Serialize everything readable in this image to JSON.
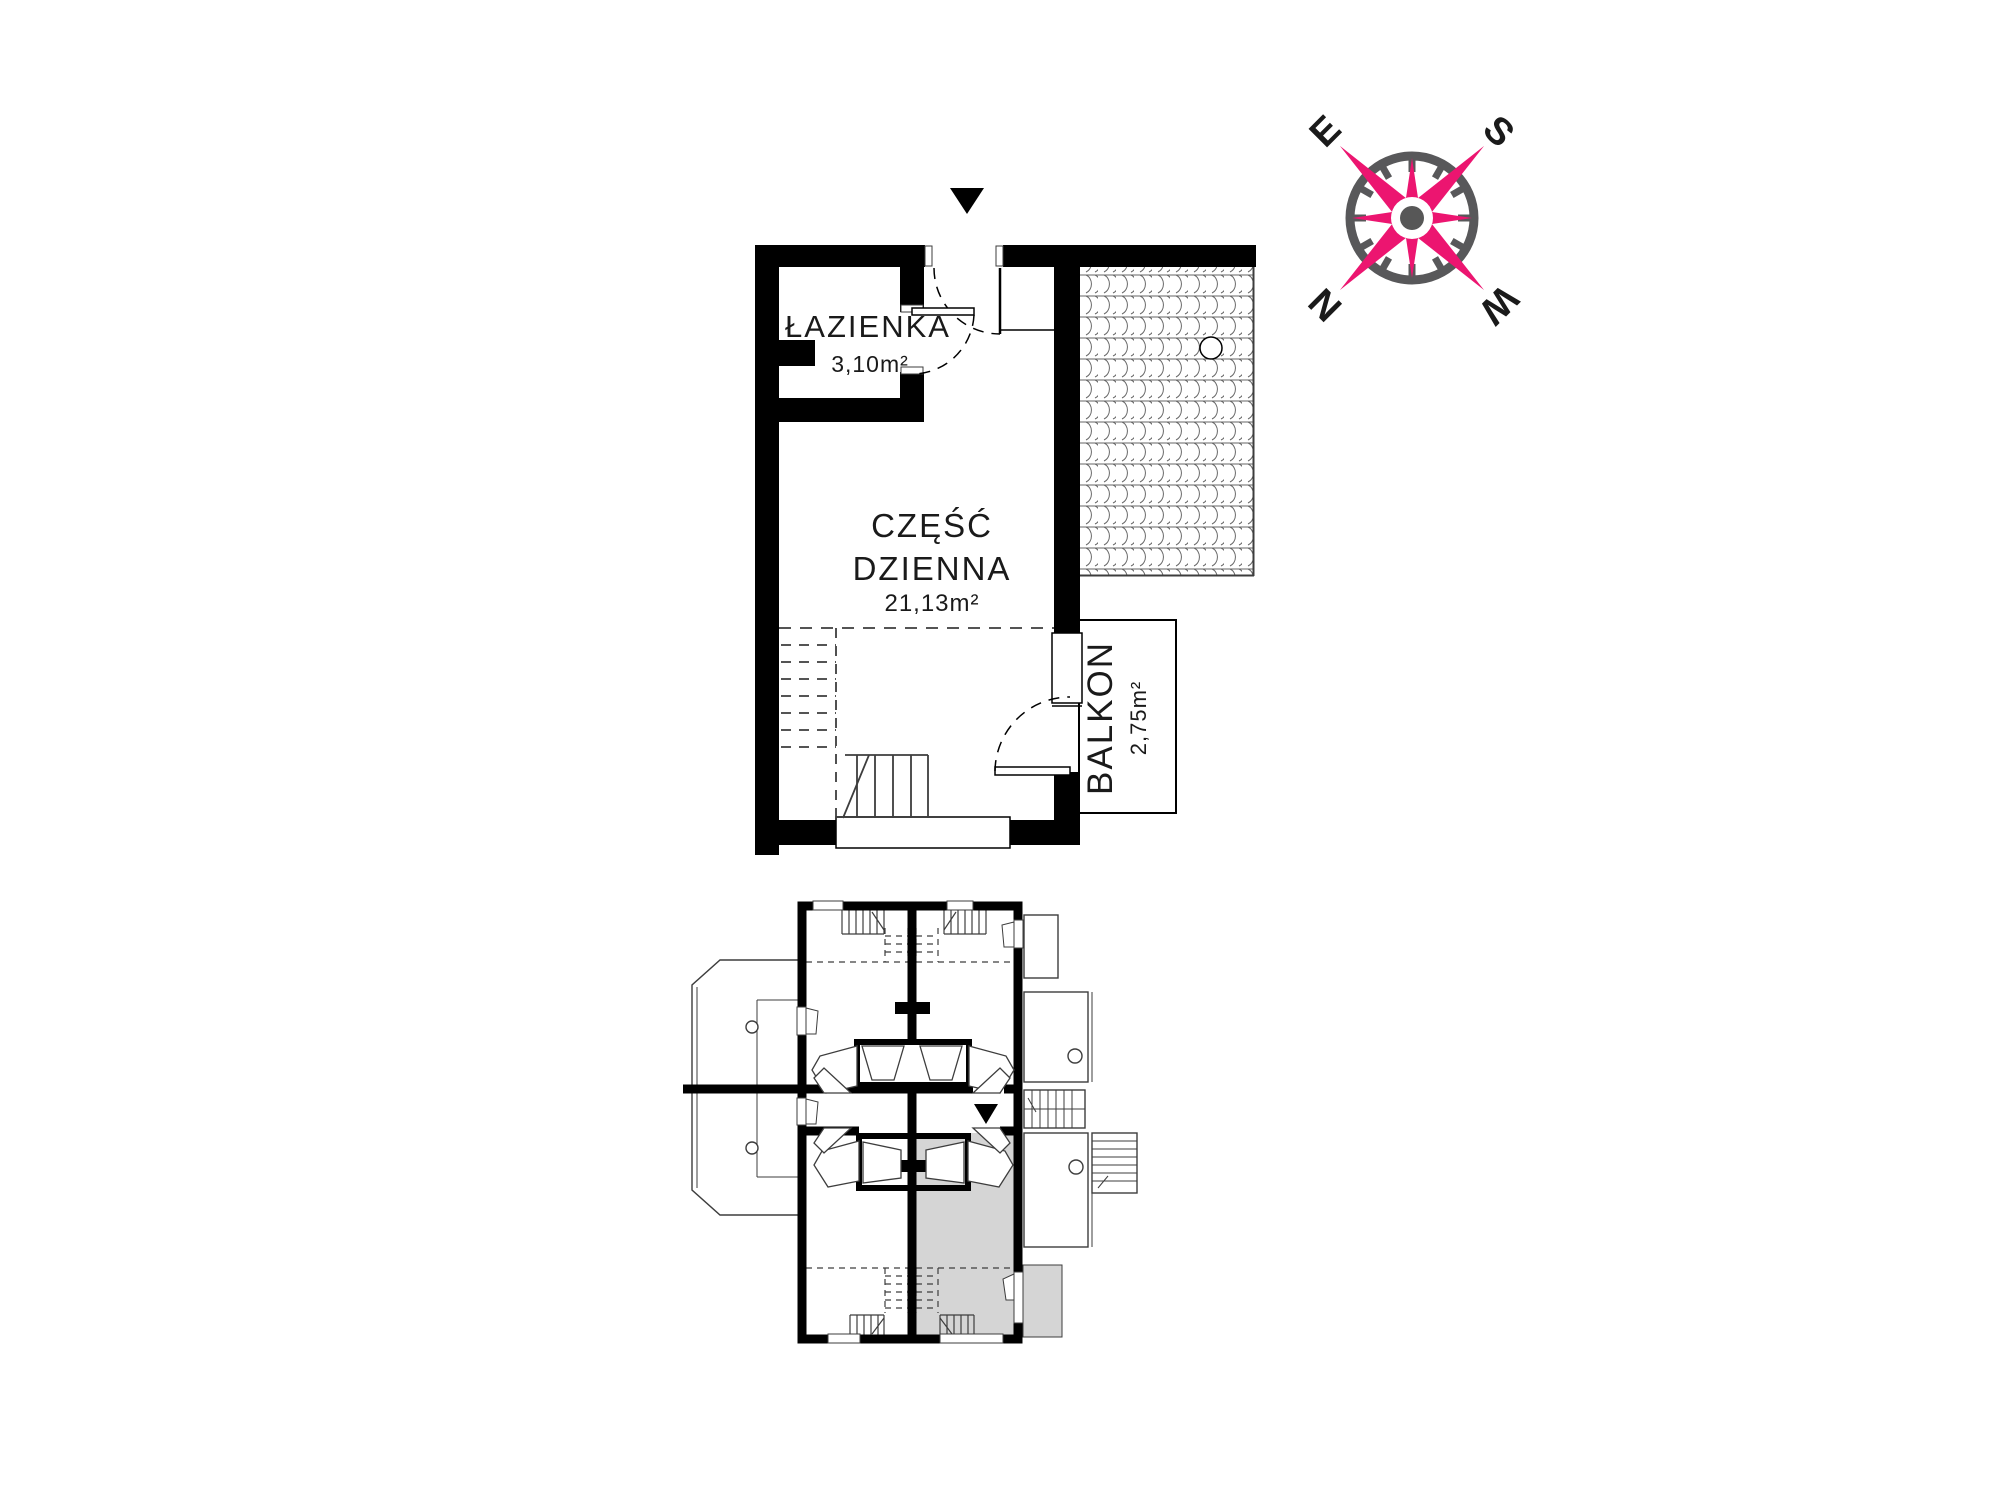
{
  "main_plan": {
    "entrance_marker": "down-arrow",
    "rooms": [
      {
        "id": "bathroom",
        "label": "ŁAZIENKA",
        "area": "3,10m²"
      },
      {
        "id": "living",
        "label_line1": "CZĘŚĆ",
        "label_line2": "DZIENNA",
        "area": "21,13m²"
      },
      {
        "id": "balcony",
        "label": "BALKON",
        "area": "2,75m²"
      }
    ]
  },
  "overview_plan": {
    "highlighted_unit": "bottom-right",
    "entrance_marker": "down-arrow"
  },
  "compass": {
    "north": "N",
    "east": "E",
    "south": "S",
    "west": "W",
    "rotation_deg": -135
  },
  "colors": {
    "wall_black": "#000000",
    "thin_line": "#3d3d3d",
    "highlight_gray": "#d5d5d5",
    "compass_pink": "#ec1570",
    "compass_gray": "#58585a",
    "compass_dot": "#575757"
  }
}
